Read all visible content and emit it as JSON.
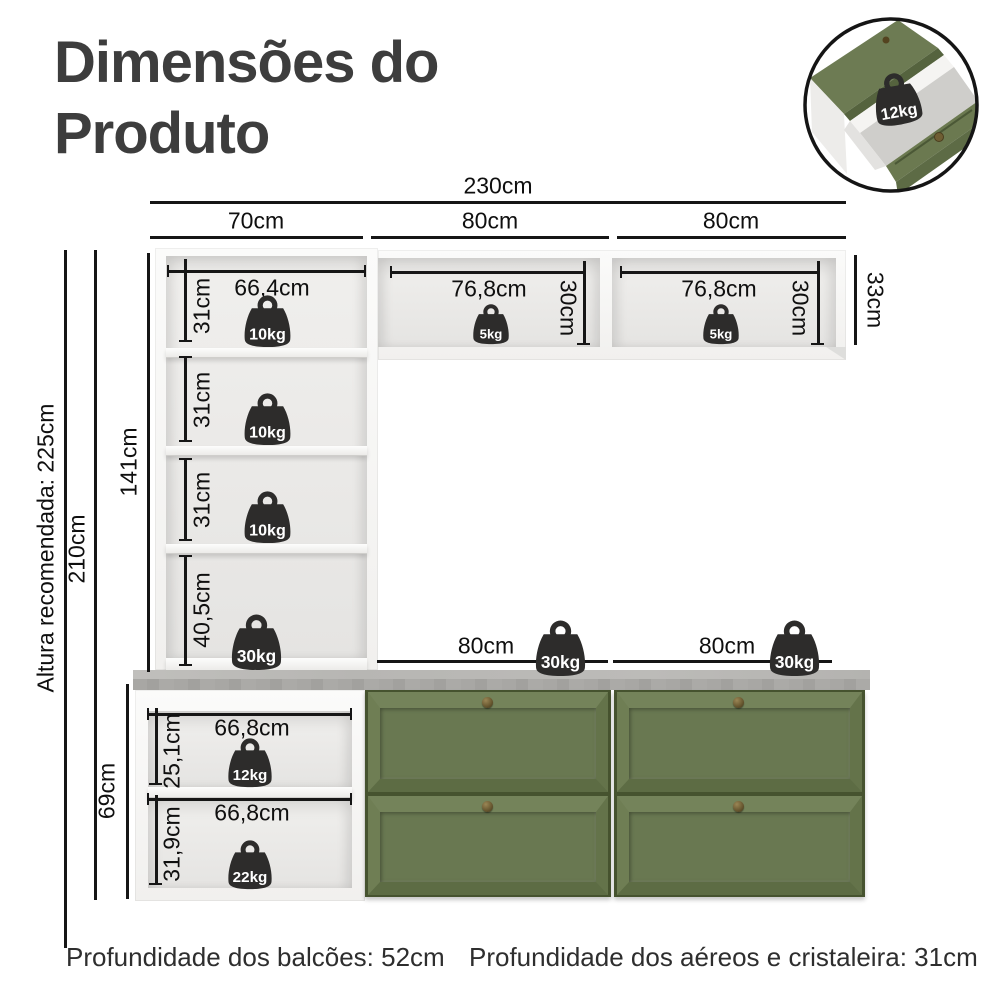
{
  "title": "Dimensões do Produto",
  "inset": {
    "weight": "12kg"
  },
  "dims": {
    "total_width": "230cm",
    "segments": [
      "70cm",
      "80cm",
      "80cm"
    ],
    "recommended_height": "Altura recomendada: 225cm",
    "total_height": "210cm",
    "hutch_height": "141cm",
    "base_height": "69cm",
    "aereo_outer_height": "33cm"
  },
  "hutch": {
    "compartments": [
      {
        "width": "66,4cm",
        "height": "31cm",
        "weight": "10kg"
      },
      {
        "height": "31cm",
        "weight": "10kg"
      },
      {
        "height": "31cm",
        "weight": "10kg"
      },
      {
        "height": "40,5cm",
        "weight": "30kg"
      }
    ]
  },
  "aereos": [
    {
      "width": "76,8cm",
      "height": "30cm",
      "weight": "5kg"
    },
    {
      "width": "76,8cm",
      "height": "30cm",
      "weight": "5kg"
    }
  ],
  "counters": [
    {
      "width": "80cm",
      "weight": "30kg"
    },
    {
      "width": "80cm",
      "weight": "30kg"
    }
  ],
  "base_cabinet": {
    "compartments": [
      {
        "width": "66,8cm",
        "height": "25,1cm",
        "weight": "12kg"
      },
      {
        "width": "66,8cm",
        "height": "31,9cm",
        "weight": "22kg"
      }
    ]
  },
  "footnotes": {
    "balcoes": "Profundidade dos balcões: 52cm",
    "aereos": "Profundidade dos aéreos e cristaleira: 31cm"
  },
  "colors": {
    "green": "#6b7a4f",
    "countertop": "#a9a8a5",
    "weight_fill": "#2d2c2b",
    "line": "#161616",
    "title_text": "#3d3d3d"
  }
}
